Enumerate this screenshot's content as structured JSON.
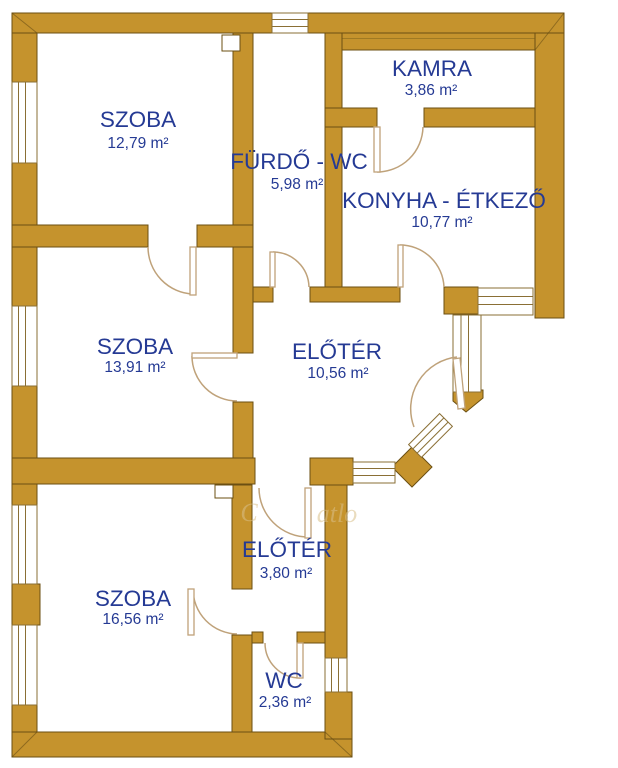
{
  "colors": {
    "wall_fill": "#C5932D",
    "wall_outline": "#6b4f12",
    "text_color": "#253a94",
    "door_arc": "#bfa27a",
    "window_line": "#8a6f35",
    "watermark": "#d9c08a"
  },
  "rooms": [
    {
      "id": "szoba-1",
      "name": "SZOBA",
      "area": "12,79 m²"
    },
    {
      "id": "kamra",
      "name": "KAMRA",
      "area": "3,86 m²"
    },
    {
      "id": "furdo-wc",
      "name": "FÜRDŐ - WC",
      "area": "5,98 m²"
    },
    {
      "id": "konyha-etkezo",
      "name": "KONYHA - ÉTKEZŐ",
      "area": "10,77 m²"
    },
    {
      "id": "szoba-2",
      "name": "SZOBA",
      "area": "13,91 m²"
    },
    {
      "id": "eloter-1",
      "name": "ELŐTÉR",
      "area": "10,56 m²"
    },
    {
      "id": "eloter-2",
      "name": "ELŐTÉR",
      "area": "3,80 m²"
    },
    {
      "id": "szoba-3",
      "name": "SZOBA",
      "area": "16,56 m²"
    },
    {
      "id": "wc",
      "name": "WC",
      "area": "2,36 m²"
    }
  ],
  "watermark": {
    "fragments": [
      "C",
      "atlo"
    ]
  }
}
